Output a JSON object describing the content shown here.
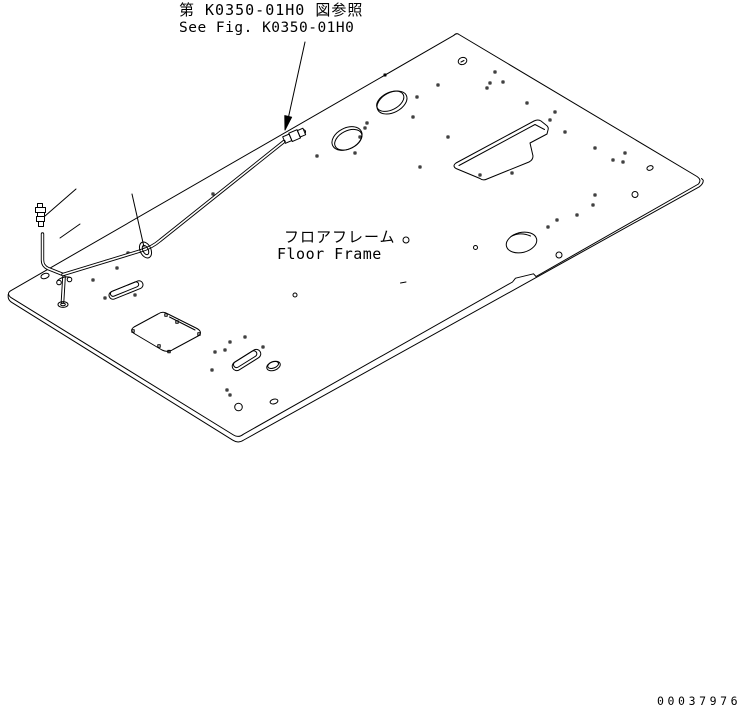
{
  "diagram": {
    "reference_note": {
      "line1_ja": "第 K0350-01H0 図参照",
      "line2_en": "See Fig. K0350-01H0"
    },
    "part_label": {
      "ja": "フロアフレーム",
      "en": "Floor Frame"
    },
    "drawing_number": "00037976"
  },
  "colors": {
    "line": "#000000",
    "background": "#ffffff"
  }
}
